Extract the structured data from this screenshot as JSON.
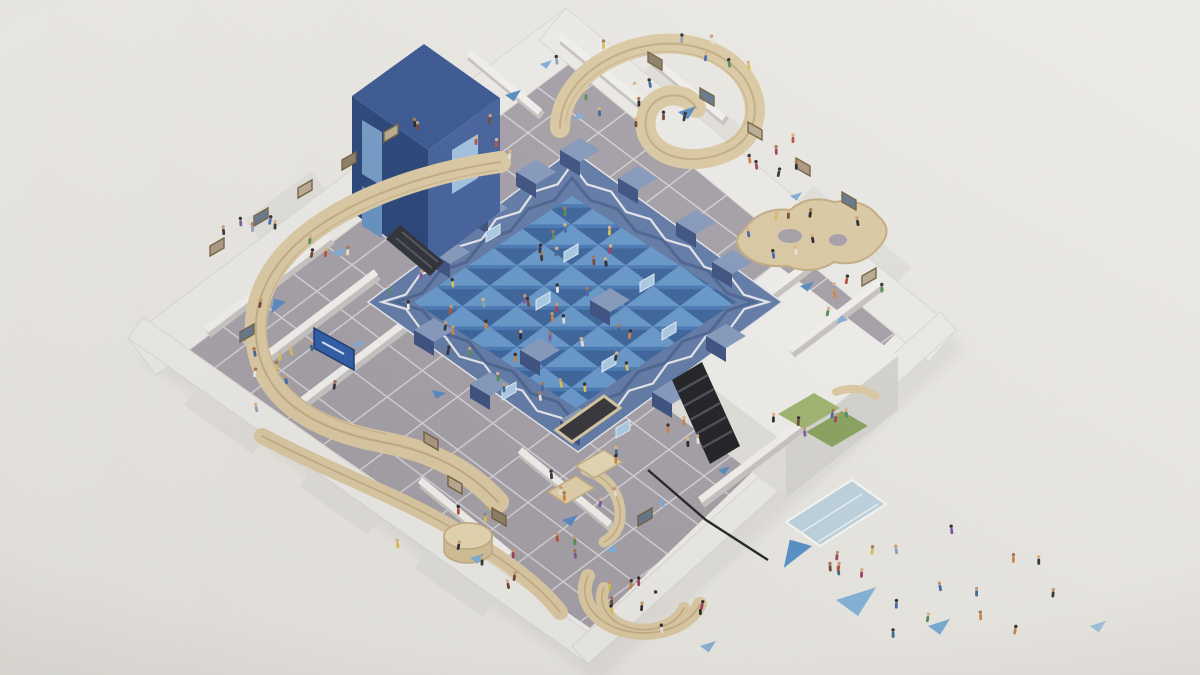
{
  "scene": {
    "palette": {
      "bg": "#edebe6",
      "building-white": "#f2f1ed",
      "building-shadow": "#d7d5d0",
      "wall-side": "#e3e1dc",
      "roof-white": "#efeeea",
      "roof-edge": "#dcdad5",
      "floor-gray": "#a39ea6",
      "floor-grid": "#e7e5e9",
      "blue-wall-mid": "#5a76a5",
      "blue-wall-dark": "#33497c",
      "blue-wall-light": "#8197bd",
      "blue-floor": "#3f74b4",
      "tri-light": "#6ba0d2",
      "tri-dark": "#2d5792",
      "tower-top": "#2e4f8e",
      "tower-left": "#1d3a73",
      "tower-right": "#3a5a99",
      "screen-blue": "#a8cbe8",
      "wood": "#ddcaa1",
      "wood-edge": "#c2ab7f",
      "wood-dark": "#b49a6e",
      "stair-black": "#141519",
      "stair-step": "#44474f",
      "green-mat": "#9cb46a",
      "green-mat-dark": "#84a057",
      "glass-blue": "#bad3e3",
      "sign-blue": "#2456a8"
    },
    "people": {
      "colors": [
        "#1d1d22",
        "#f2f0ea",
        "#3b62a8",
        "#b5472f",
        "#4b8a4f",
        "#7a4f9e",
        "#d9c04a",
        "#6b3f2a",
        "#cf7f3a",
        "#2a2a2e",
        "#e8e4da",
        "#8aa0b8",
        "#32628f",
        "#9e3558"
      ],
      "skins": [
        "#c9996f",
        "#a5714a",
        "#e0b185",
        "#2a2320"
      ],
      "clusters": [
        {
          "name": "central-floor",
          "cx": 540,
          "cy": 330,
          "rx": 105,
          "ry": 70,
          "count": 26
        },
        {
          "name": "central-upper",
          "cx": 580,
          "cy": 245,
          "rx": 65,
          "ry": 42,
          "count": 10
        },
        {
          "name": "top-gallery",
          "cx": 645,
          "cy": 80,
          "rx": 115,
          "ry": 58,
          "count": 15
        },
        {
          "name": "topleft-gallery",
          "cx": 465,
          "cy": 135,
          "rx": 55,
          "ry": 35,
          "count": 6
        },
        {
          "name": "left-gallery",
          "cx": 275,
          "cy": 260,
          "rx": 75,
          "ry": 48,
          "count": 10
        },
        {
          "name": "left-ramp",
          "cx": 300,
          "cy": 380,
          "rx": 68,
          "ry": 42,
          "count": 9
        },
        {
          "name": "midleft-gallery",
          "cx": 425,
          "cy": 305,
          "rx": 45,
          "ry": 35,
          "count": 6
        },
        {
          "name": "bottom-gallery",
          "cx": 480,
          "cy": 545,
          "rx": 105,
          "ry": 42,
          "count": 12
        },
        {
          "name": "amphitheater",
          "cx": 648,
          "cy": 608,
          "rx": 55,
          "ry": 36,
          "count": 10
        },
        {
          "name": "shop-area",
          "cx": 598,
          "cy": 472,
          "rx": 50,
          "ry": 38,
          "count": 7
        },
        {
          "name": "right-room",
          "cx": 812,
          "cy": 238,
          "rx": 65,
          "ry": 32,
          "count": 8
        },
        {
          "name": "right-gallery",
          "cx": 856,
          "cy": 302,
          "rx": 40,
          "ry": 28,
          "count": 5
        },
        {
          "name": "green-room",
          "cx": 815,
          "cy": 418,
          "rx": 42,
          "ry": 20,
          "count": 6
        },
        {
          "name": "stair-area",
          "cx": 700,
          "cy": 435,
          "rx": 35,
          "ry": 30,
          "count": 4
        },
        {
          "name": "plaza",
          "cx": 965,
          "cy": 580,
          "rx": 135,
          "ry": 68,
          "count": 14
        },
        {
          "name": "entrance",
          "cx": 845,
          "cy": 550,
          "rx": 32,
          "ry": 22,
          "count": 4
        },
        {
          "name": "topright-gallery",
          "cx": 762,
          "cy": 162,
          "rx": 55,
          "ry": 32,
          "count": 6
        }
      ]
    },
    "floor_triangles": [
      {
        "x": 505,
        "y": 95,
        "s": 16,
        "rot": 0,
        "color": "#4f86c2"
      },
      {
        "x": 585,
        "y": 118,
        "s": 12,
        "rot": 190,
        "color": "#7dabd8"
      },
      {
        "x": 678,
        "y": 112,
        "s": 18,
        "rot": 0,
        "color": "#4f86c2"
      },
      {
        "x": 332,
        "y": 252,
        "s": 14,
        "rot": 0,
        "color": "#7dabd8"
      },
      {
        "x": 286,
        "y": 302,
        "s": 18,
        "rot": 160,
        "color": "#4f86c2"
      },
      {
        "x": 352,
        "y": 344,
        "s": 12,
        "rot": 0,
        "color": "#7dabd8"
      },
      {
        "x": 432,
        "y": 390,
        "s": 14,
        "rot": 30,
        "color": "#4f86c2"
      },
      {
        "x": 562,
        "y": 520,
        "s": 16,
        "rot": 0,
        "color": "#4f86c2"
      },
      {
        "x": 618,
        "y": 552,
        "s": 12,
        "rot": 200,
        "color": "#7dabd8"
      },
      {
        "x": 470,
        "y": 558,
        "s": 14,
        "rot": 0,
        "color": "#7dabd8"
      },
      {
        "x": 800,
        "y": 286,
        "s": 14,
        "rot": 0,
        "color": "#4f86c2"
      },
      {
        "x": 848,
        "y": 320,
        "s": 12,
        "rot": 180,
        "color": "#7dabd8"
      },
      {
        "x": 790,
        "y": 196,
        "s": 12,
        "rot": 0,
        "color": "#7dabd8"
      },
      {
        "x": 718,
        "y": 470,
        "s": 12,
        "rot": 0,
        "color": "#4f86c2"
      },
      {
        "x": 662,
        "y": 498,
        "s": 10,
        "rot": 90,
        "color": "#7dabd8"
      },
      {
        "x": 540,
        "y": 64,
        "s": 12,
        "rot": 0,
        "color": "#7dabd8"
      }
    ],
    "plaza_triangles": [
      {
        "x": 836,
        "y": 600,
        "s": 40,
        "rot": 0,
        "color": "#7fb2da"
      },
      {
        "x": 812,
        "y": 546,
        "s": 34,
        "rot": 160,
        "color": "#4f8ec8"
      },
      {
        "x": 928,
        "y": 626,
        "s": 22,
        "rot": 0,
        "color": "#74a9d4"
      },
      {
        "x": 1090,
        "y": 626,
        "s": 16,
        "rot": 0,
        "color": "#9bc1e0"
      },
      {
        "x": 700,
        "y": 646,
        "s": 16,
        "rot": 0,
        "color": "#86b2d8"
      }
    ],
    "artworks": [
      {
        "x": 210,
        "y": 246,
        "dir": 1,
        "color": "#a9947a"
      },
      {
        "x": 254,
        "y": 216,
        "dir": 1,
        "color": "#5d7186"
      },
      {
        "x": 298,
        "y": 188,
        "dir": 1,
        "color": "#b9aa8e"
      },
      {
        "x": 342,
        "y": 160,
        "dir": 1,
        "color": "#8a7a5f"
      },
      {
        "x": 240,
        "y": 332,
        "dir": 1,
        "color": "#5d7186"
      },
      {
        "x": 384,
        "y": 132,
        "dir": 1,
        "color": "#b9aa8e"
      },
      {
        "x": 648,
        "y": 52,
        "dir": -1,
        "color": "#8a7a5f"
      },
      {
        "x": 700,
        "y": 88,
        "dir": -1,
        "color": "#5d7186"
      },
      {
        "x": 748,
        "y": 122,
        "dir": -1,
        "color": "#b9aa8e"
      },
      {
        "x": 796,
        "y": 158,
        "dir": -1,
        "color": "#a9947a"
      },
      {
        "x": 842,
        "y": 192,
        "dir": -1,
        "color": "#5d7186"
      },
      {
        "x": 448,
        "y": 476,
        "dir": -1,
        "color": "#b9aa8e"
      },
      {
        "x": 492,
        "y": 508,
        "dir": -1,
        "color": "#8a7a5f"
      },
      {
        "x": 424,
        "y": 432,
        "dir": -1,
        "color": "#a9947a"
      },
      {
        "x": 862,
        "y": 276,
        "dir": 1,
        "color": "#b9aa8e"
      },
      {
        "x": 638,
        "y": 516,
        "dir": 1,
        "color": "#5d7186"
      }
    ],
    "wall_stubs": [
      [
        468,
        208
      ],
      [
        516,
        172
      ],
      [
        560,
        150
      ],
      [
        618,
        178
      ],
      [
        676,
        222
      ],
      [
        712,
        262
      ],
      [
        706,
        336
      ],
      [
        652,
        392
      ],
      [
        560,
        420
      ],
      [
        470,
        384
      ],
      [
        414,
        330
      ],
      [
        430,
        252
      ],
      [
        590,
        300
      ],
      [
        520,
        350
      ]
    ],
    "screens": [
      [
        486,
        232
      ],
      [
        536,
        300
      ],
      [
        602,
        362
      ],
      [
        640,
        282
      ],
      [
        564,
        252
      ],
      [
        616,
        428
      ],
      [
        502,
        390
      ],
      [
        662,
        330
      ]
    ]
  }
}
